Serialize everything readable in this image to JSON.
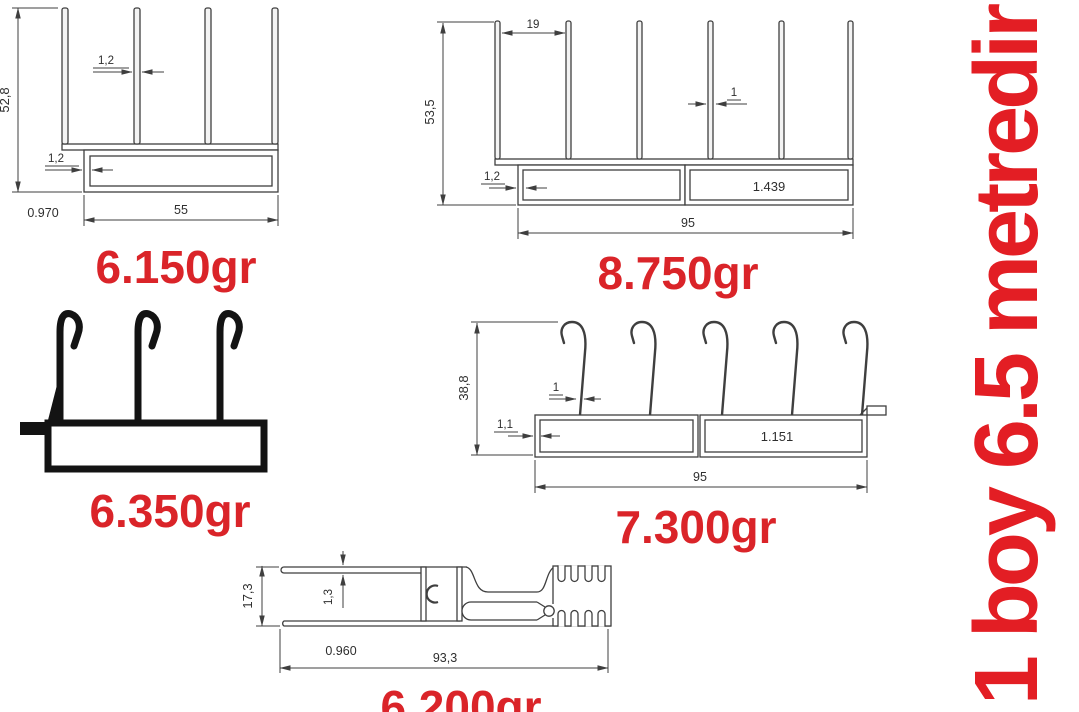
{
  "side_note": {
    "text": "1 boy 6.5 metredir"
  },
  "colors": {
    "red": "#da2429",
    "line": "#3f3f3f",
    "black": "#131313"
  },
  "profiles": {
    "a": {
      "weight": "6.150gr",
      "height": "52,8",
      "fin_thickness": "1,2",
      "wall_thickness": "1,2",
      "side_value": "0.970",
      "width": "55"
    },
    "b": {
      "weight": "8.750gr",
      "height": "53,5",
      "fin_spacing": "19",
      "fin_thickness": "1",
      "wall_thickness": "1,2",
      "box_value": "1.439",
      "width": "95"
    },
    "c": {
      "weight": "6.350gr"
    },
    "d": {
      "weight": "7.300gr",
      "height": "38,8",
      "hook_thickness": "1",
      "wall_thickness": "1,1",
      "box_value": "1.151",
      "width": "95"
    },
    "e": {
      "weight": "6.200gr",
      "height": "17,3",
      "wall_thickness": "1,3",
      "side_value": "0.960",
      "width": "93,3"
    }
  }
}
